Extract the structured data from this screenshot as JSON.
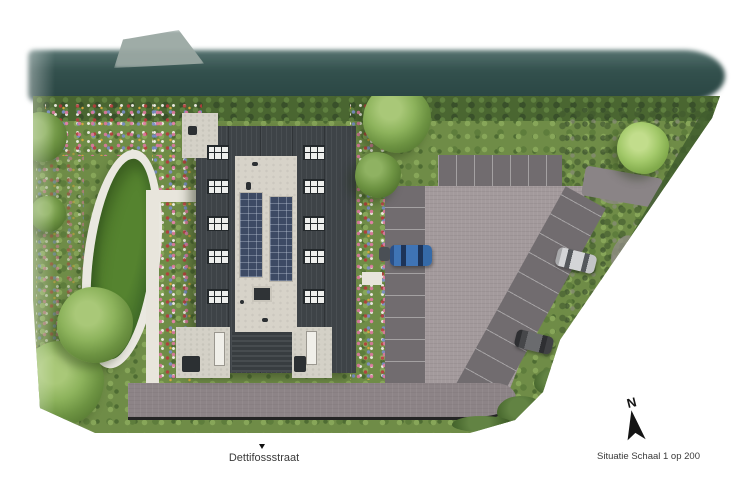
{
  "plan": {
    "street_label": "Dettifossstraat",
    "scale_label": "Situatie Schaal 1 op 200",
    "compass_north": "N"
  },
  "legend_colors": {
    "canal_water": "#2f4c49",
    "greenery": "#6f8c47",
    "pond": "#44702a",
    "roof_dark": "#3e4347",
    "roof_light": "#d7d3c9",
    "solar_panel": "#3d4a64",
    "parking_court": "#a39a9c",
    "parking_row": "#716c6f",
    "road": "#8d8487",
    "footpath": "#e8e5dc",
    "car_blue": "#3f74b5",
    "car_silver": "#d4d5d7",
    "car_dark": "#46474a"
  }
}
